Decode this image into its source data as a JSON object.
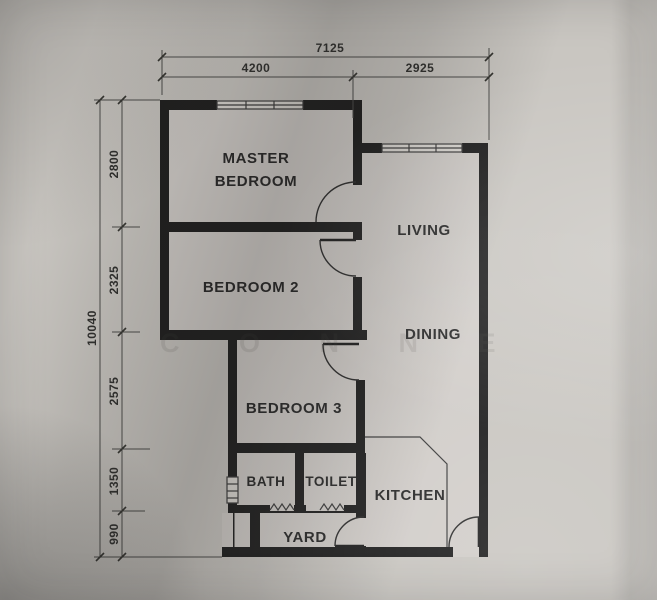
{
  "plan": {
    "rooms": {
      "master_line1": "MASTER",
      "master_line2": "BEDROOM",
      "bedroom2": "BEDROOM 2",
      "bedroom3": "BEDROOM 3",
      "living": "LIVING",
      "dining": "DINING",
      "kitchen": "KITCHEN",
      "bath": "BATH",
      "toilet": "TOILET",
      "yard": "YARD"
    },
    "dimensions": {
      "top_total": "7125",
      "top_segments": [
        "4200",
        "2925"
      ],
      "left_total": "10040",
      "left_segments": [
        "2800",
        "2325",
        "2575",
        "1350",
        "990"
      ]
    },
    "watermark": "C O N N E",
    "colors": {
      "paper": "#c9c6c1",
      "wall": "#1c1c1c",
      "text": "#262626"
    }
  }
}
